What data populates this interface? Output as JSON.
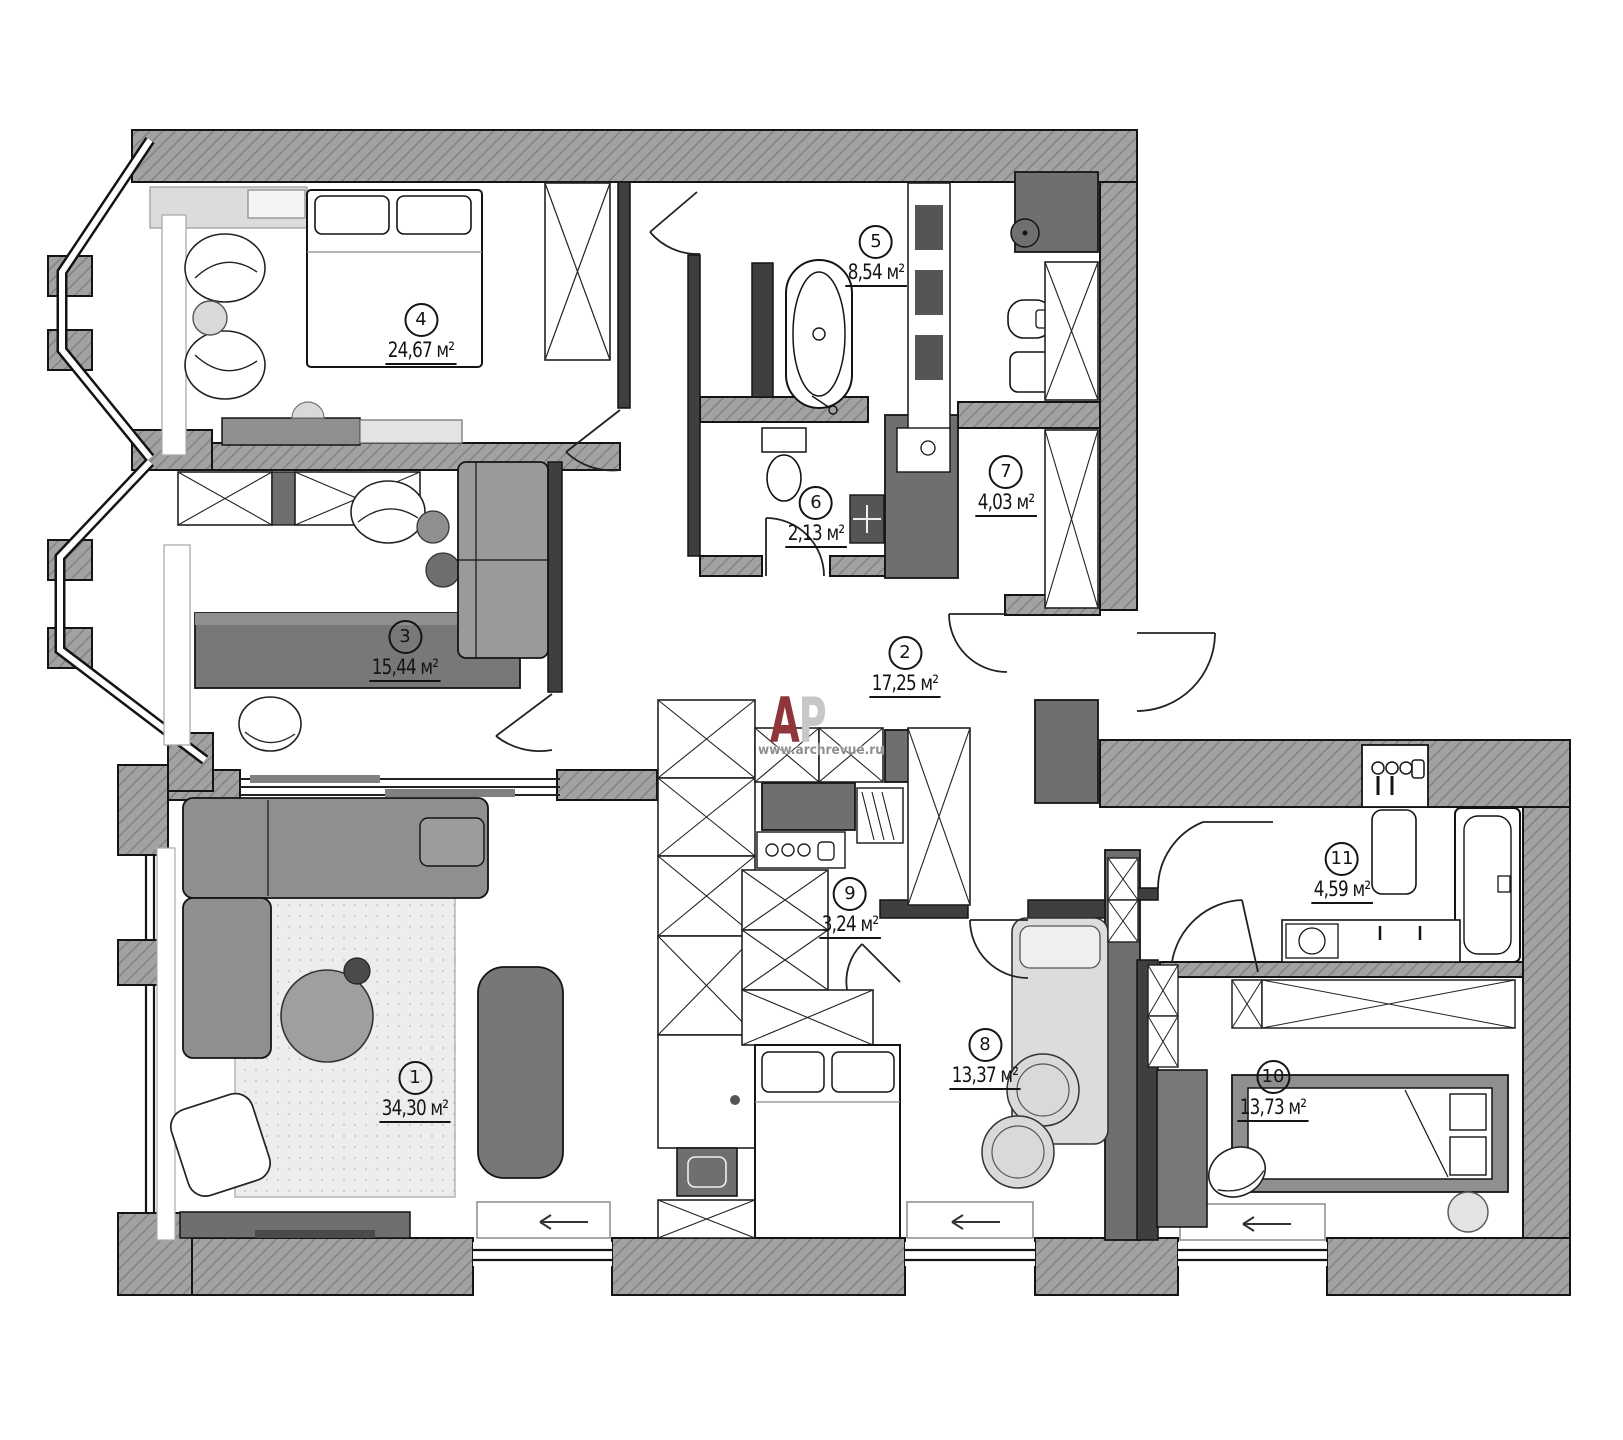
{
  "plan": {
    "type": "apartment floor plan",
    "rooms": [
      {
        "number": "1",
        "area": "34,30 м²"
      },
      {
        "number": "2",
        "area": "17,25 м²"
      },
      {
        "number": "3",
        "area": "15,44 м²"
      },
      {
        "number": "4",
        "area": "24,67 м²"
      },
      {
        "number": "5",
        "area": "8,54 м²"
      },
      {
        "number": "6",
        "area": "2,13 м²"
      },
      {
        "number": "7",
        "area": "4,03 м²"
      },
      {
        "number": "8",
        "area": "13,37 м²"
      },
      {
        "number": "9",
        "area": "3,24 м²"
      },
      {
        "number": "10",
        "area": "13,73 м²"
      },
      {
        "number": "11",
        "area": "4,59 м²"
      }
    ],
    "watermark": {
      "letter_a": "А",
      "letter_p": "Р",
      "url": "www.archrevue.ru"
    },
    "colors": {
      "wall_hatch": "#a0a0a0",
      "wall_dark": "#6f6f6f",
      "partition": "#3f3f3f",
      "line": "#141414",
      "furniture_dark": "#787878",
      "furniture_mid": "#8f8f8f",
      "furniture_light": "#d9d9d9",
      "rug": "#ececec",
      "logo_red": "#8e3639",
      "logo_gray": "#c7c7c7"
    }
  }
}
